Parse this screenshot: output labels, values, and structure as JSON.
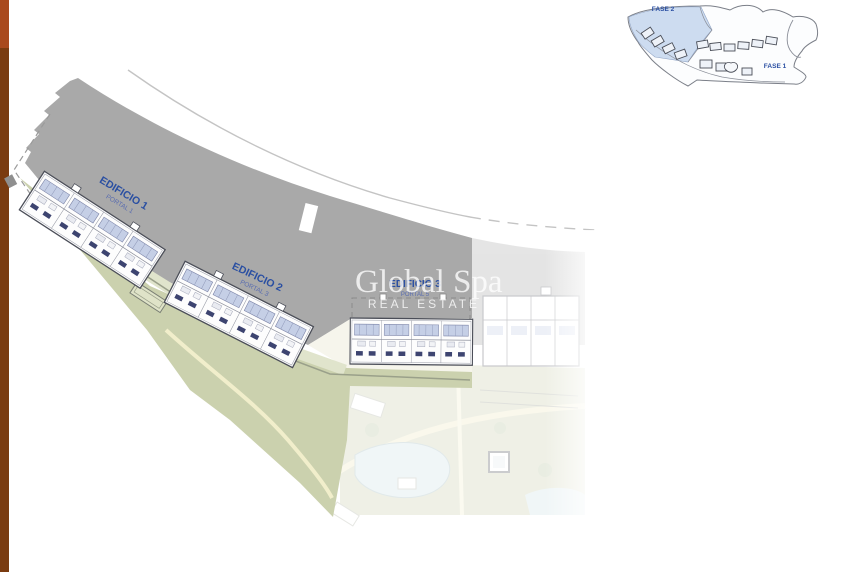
{
  "side_stripe": {
    "top_color": "#a9491d",
    "bottom_color": "#7a3b10"
  },
  "colors": {
    "band_grey": "#a9a9a9",
    "green": "#cbd1ae",
    "green_light": "#e0e4cc",
    "path_cream": "#f1eecb",
    "road_grey": "#c4c4c4",
    "label_blue": "#2a4fa2",
    "building_outline": "#4b4e58",
    "terrace_blue": "#c5cfe6",
    "window_blue": "#3d4470",
    "watermark_white": "rgba(255,255,255,0.78)",
    "inset_highlight": "#cddcf0",
    "pool_blue": "#cfe3e6",
    "forecourt_cream": "#f6f5ec"
  },
  "labels": {
    "edificio1": {
      "title": "EDIFICIO 1",
      "subtitle": "PORTAL 1"
    },
    "edificio2": {
      "title": "EDIFICIO 2",
      "subtitle": "PORTAL 3"
    },
    "edificio3": {
      "title": "EDIFICIO 3",
      "subtitle": "PORTAL 5"
    }
  },
  "watermark": {
    "line1": "Global Spa",
    "line2": "REAL ESTATE"
  },
  "inset": {
    "fase2_label": "FASE 2",
    "fase1_label": "FASE 1"
  }
}
